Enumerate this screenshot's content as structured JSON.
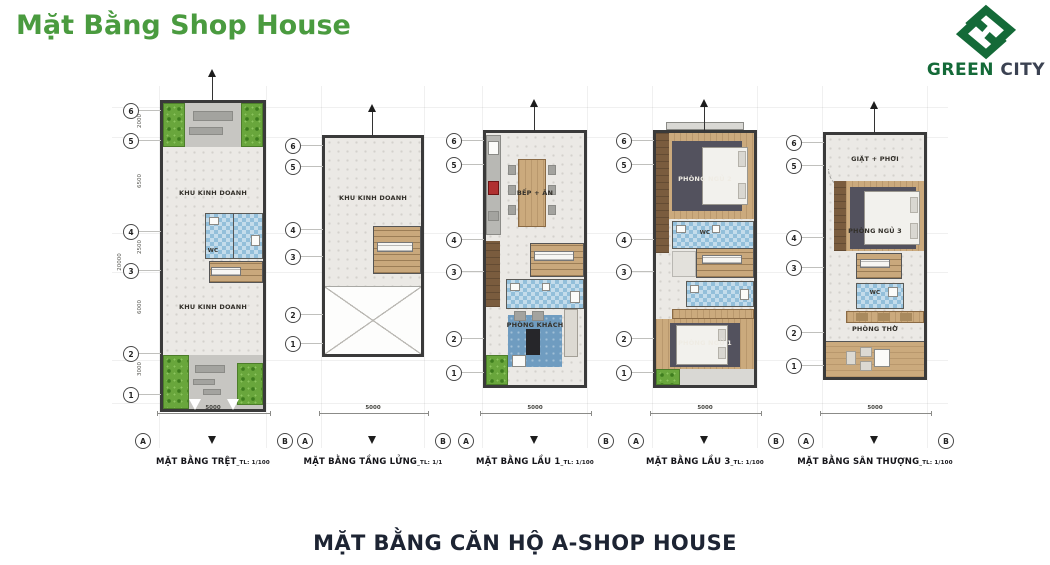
{
  "header": {
    "title": "Mặt Bằng Shop House"
  },
  "logo": {
    "brand_green": "GREEN",
    "brand_dark": "CITY"
  },
  "footer": {
    "title": "MẶT BẰNG CĂN HỘ A-SHOP HOUSE"
  },
  "grid": {
    "row_markers": [
      "6",
      "5",
      "4",
      "3",
      "2",
      "1"
    ],
    "col_markers": [
      "A",
      "B"
    ],
    "segment_dims": [
      "2000",
      "6500",
      "2500",
      "6000",
      "3000"
    ],
    "total_dim": "20000",
    "width_dim": "5000"
  },
  "plans": [
    {
      "name": "MẶT BẰNG TRỆT",
      "scale": "_TL: 1/100",
      "rooms": {
        "business_upper": "KHU KINH DOANH",
        "wc": "WC",
        "business_lower": "KHU KINH DOANH"
      }
    },
    {
      "name": "MẶT BẰNG TẦNG LỬNG",
      "scale": "_TL: 1/1",
      "rooms": {
        "business": "KHU KINH DOANH"
      }
    },
    {
      "name": "MẶT BẰNG LẦU 1",
      "scale": "_TL: 1/100",
      "rooms": {
        "kitchen_dining": "BẾP + ĂN",
        "living": "PHÒNG KHÁCH"
      }
    },
    {
      "name": "MẶT BẰNG LẦU 3",
      "scale": "_TL: 1/100",
      "rooms": {
        "bedroom2": "PHÒNG NGỦ 2",
        "wc": "WC",
        "bedroom1": "PHÒNG NGỦ 1"
      }
    },
    {
      "name": "MẶT BẰNG SÂN THƯỢNG",
      "scale": "_TL: 1/100",
      "rooms": {
        "laundry": "GIẶT + PHƠI",
        "bedroom3": "PHÒNG NGỦ 3",
        "wc": "WC",
        "altar": "PHÒNG THỜ"
      }
    }
  ],
  "colors": {
    "accent_green": "#4a9b3f",
    "logo_green": "#146a38",
    "logo_dark": "#3b4252",
    "wall": "#3a3a3a",
    "tile_blue": "#93bfda",
    "wood": "#cbaa7d",
    "planter_green": "#69a63c",
    "footer_text": "#1d2433"
  }
}
